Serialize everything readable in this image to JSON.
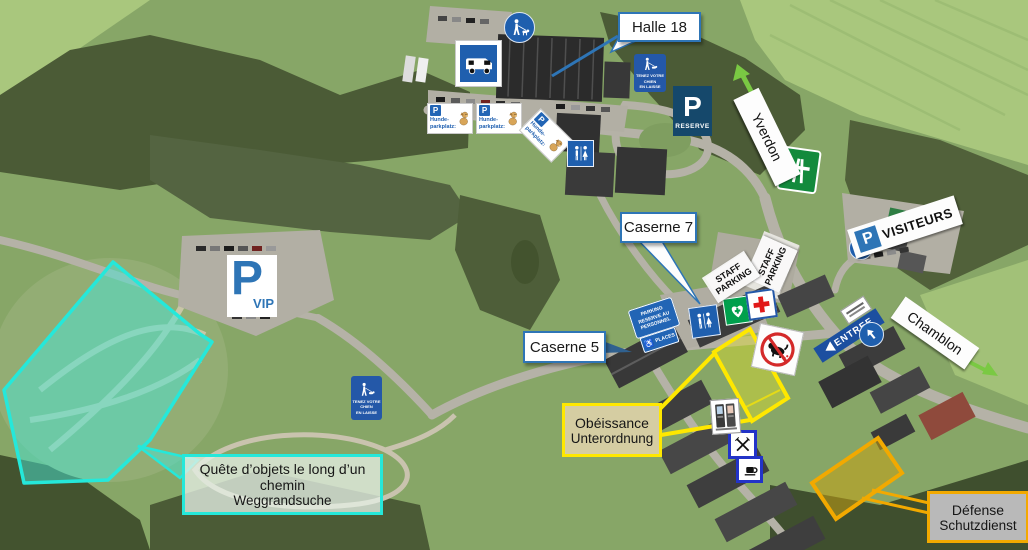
{
  "callouts": {
    "halle18": "Halle 18",
    "caserne7": "Caserne 7",
    "caserne5": "Caserne 5"
  },
  "areas": {
    "quete": {
      "line1": "Quête d’objets le long d’un chemin",
      "line2": "Weggrandsuche",
      "color": "#25e8da"
    },
    "obeissance": {
      "line1": "Obéissance",
      "line2": "Unterordnung",
      "color": "#ffe800"
    },
    "defense": {
      "line1": "Défense",
      "line2": "Schutzdienst",
      "color": "#f2a900"
    }
  },
  "directions": {
    "yverdon": "Yverdon",
    "chamblon": "Chamblon",
    "entree": "ENTREE"
  },
  "parking": {
    "p": "P",
    "vip": "VIP",
    "visiteurs": "VISITEURS",
    "reserve": "RESERVE",
    "staff": {
      "line1": "STAFF",
      "line2": "PARKING"
    },
    "personnel": {
      "line1": "PARKING",
      "line2": "RESERVE AU",
      "line3": "PERSONNEL"
    },
    "places": "PLACES",
    "hunde": {
      "line1": "Hunde-",
      "line2": "parkplatz:"
    }
  },
  "signs": {
    "leash": {
      "line1": "TENEZ VOTRE CHIEN",
      "line2": "EN LAISSE"
    }
  },
  "icons": {
    "wheelchair": "♿"
  },
  "colors": {
    "callout_blue": "#2e75b6",
    "entree_blue": "#1c4fa0",
    "arrow_green": "#7ac943"
  }
}
